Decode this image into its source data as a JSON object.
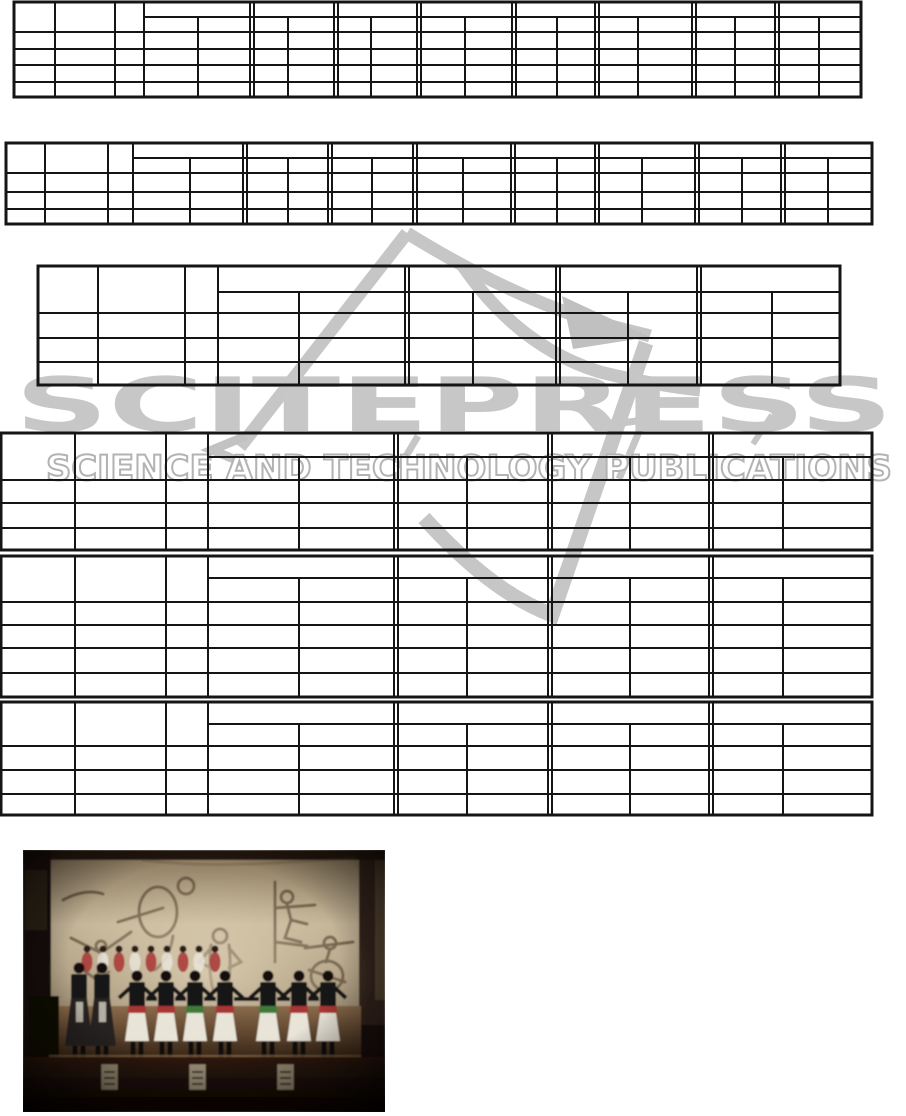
{
  "watermark": {
    "brand": "SCITEPRESS",
    "tagline": "SCIENCE AND TECHNOLOGY PUBLICATIONS",
    "brand_color": "#c7c7c7",
    "outline_color": "#b3b3b3",
    "logo_color": "#c6c6c6"
  },
  "table_style": {
    "line_color": "#151515"
  },
  "tables": [
    {
      "name": "table-1",
      "x": 14,
      "y": 2,
      "w": 847,
      "h": 95,
      "lead_x": [
        41,
        101,
        130
      ],
      "groups": [
        {
          "sub": 184,
          "end": 238
        },
        {
          "sub": 274,
          "end": 322
        },
        {
          "sub": 357,
          "end": 405
        },
        {
          "sub": 451,
          "end": 500
        },
        {
          "sub": 543,
          "end": 583
        },
        {
          "sub": 624,
          "end": 680
        },
        {
          "sub": 721,
          "end": 763
        },
        {
          "sub": 805,
          "end": 847
        }
      ],
      "row_y": [
        15,
        30,
        47,
        63,
        80
      ]
    },
    {
      "name": "table-2",
      "x": 6,
      "y": 143,
      "w": 866,
      "h": 81,
      "lead_x": [
        39,
        102,
        127
      ],
      "groups": [
        {
          "sub": 184,
          "end": 239
        },
        {
          "sub": 282,
          "end": 324
        },
        {
          "sub": 366,
          "end": 409
        },
        {
          "sub": 457,
          "end": 507
        },
        {
          "sub": 551,
          "end": 591
        },
        {
          "sub": 636,
          "end": 691
        },
        {
          "sub": 736,
          "end": 777
        },
        {
          "sub": 822,
          "end": 866
        }
      ],
      "row_y": [
        15,
        30,
        49,
        66
      ]
    },
    {
      "name": "table-3",
      "x": 38,
      "y": 266,
      "w": 802,
      "h": 119,
      "lead_x": [
        60,
        147,
        180
      ],
      "groups": [
        {
          "sub": 261,
          "end": 369
        },
        {
          "sub": 435,
          "end": 520
        },
        {
          "sub": 590,
          "end": 661
        },
        {
          "sub": 734,
          "end": 802
        }
      ],
      "row_y": [
        26,
        47,
        72,
        96
      ]
    },
    {
      "name": "table-4",
      "x": 1,
      "y": 433,
      "w": 871,
      "h": 117,
      "lead_x": [
        74,
        165,
        207
      ],
      "groups": [
        {
          "sub": 298,
          "end": 395
        },
        {
          "sub": 466,
          "end": 549
        },
        {
          "sub": 629,
          "end": 710
        },
        {
          "sub": 782,
          "end": 871
        }
      ],
      "row_y": [
        24,
        47,
        70,
        95
      ]
    },
    {
      "name": "table-5",
      "x": 1,
      "y": 556,
      "w": 871,
      "h": 141,
      "lead_x": [
        74,
        165,
        207
      ],
      "groups": [
        {
          "sub": 298,
          "end": 395
        },
        {
          "sub": 466,
          "end": 549
        },
        {
          "sub": 629,
          "end": 710
        },
        {
          "sub": 782,
          "end": 871
        }
      ],
      "row_y": [
        22,
        46,
        69,
        92,
        117
      ]
    },
    {
      "name": "table-6",
      "x": 1,
      "y": 702,
      "w": 871,
      "h": 113,
      "lead_x": [
        74,
        165,
        207
      ],
      "groups": [
        {
          "sub": 298,
          "end": 395
        },
        {
          "sub": 466,
          "end": 549
        },
        {
          "sub": 629,
          "end": 710
        },
        {
          "sub": 782,
          "end": 871
        }
      ],
      "row_y": [
        22,
        44,
        68,
        92
      ]
    }
  ],
  "photo": {
    "x": 23,
    "y": 850,
    "width": 362,
    "height": 262,
    "scene": "folk-dance-troupe-on-stage-with-sketched-mural-backdrop",
    "palette": {
      "backdrop": "#b9a98c",
      "backdrop_dark": "#8d7c61",
      "sketch": "#564431",
      "floor": "#7a5940",
      "floor_dark": "#4a3120",
      "stage_front": "#2a180e",
      "top_black": "#131313",
      "skirt_white": "#e9e4d8",
      "sash_red": "#a83434",
      "sash_green": "#3f7a3a",
      "boot_black": "#0d0d0d",
      "poster": "#9b8f78",
      "hair": "#17100a"
    },
    "line_dancers": [
      {
        "x": 114,
        "sash": "#a83434"
      },
      {
        "x": 143,
        "sash": "#a83434"
      },
      {
        "x": 172,
        "sash": "#3f7a3a"
      },
      {
        "x": 202,
        "sash": "#a83434"
      },
      {
        "x": 245,
        "sash": "#3f7a3a"
      },
      {
        "x": 276,
        "sash": "#a83434"
      },
      {
        "x": 305,
        "sash": "#a83434"
      }
    ],
    "side_figures": [
      {
        "x": 56
      },
      {
        "x": 79
      }
    ],
    "back_row_xs": [
      64,
      80,
      96,
      112,
      128,
      144,
      160,
      176,
      192
    ],
    "poster_xs": [
      86,
      174,
      262
    ]
  }
}
